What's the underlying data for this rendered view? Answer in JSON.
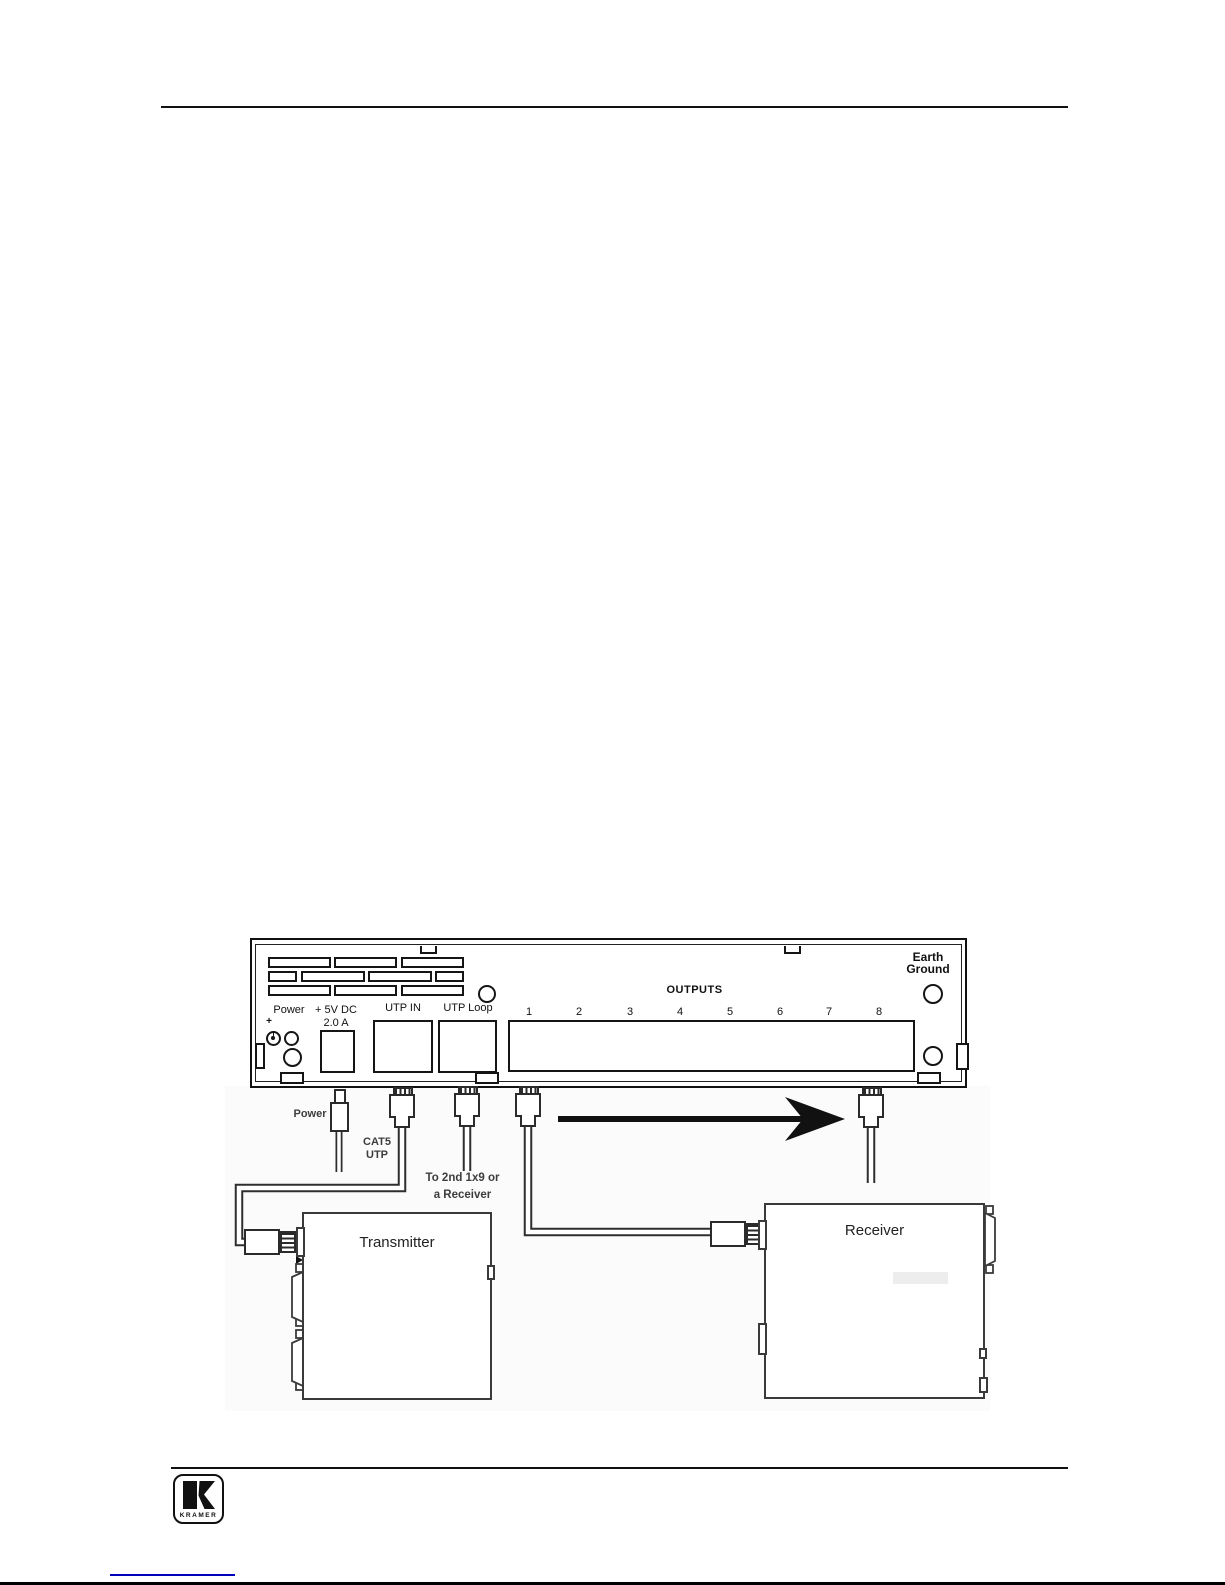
{
  "panel": {
    "earth_label_line1": "Earth",
    "earth_label_line2": "Ground",
    "outputs_label": "OUTPUTS",
    "output_numbers": [
      "1",
      "2",
      "3",
      "4",
      "5",
      "6",
      "7",
      "8"
    ],
    "power_label": "Power",
    "plus_label": "+",
    "dc_label_line1": "+ 5V DC",
    "dc_label_line2": "2.0 A",
    "utp_in_label": "UTP IN",
    "utp_loop_label": "UTP Loop"
  },
  "connections": {
    "power_cable_label": "Power",
    "cat5_label_line1": "CAT5",
    "cat5_label_line2": "UTP",
    "loop_label_line1": "To 2nd 1x9 or",
    "loop_label_line2": "a Receiver",
    "transmitter_label": "Transmitter",
    "receiver_label": "Receiver"
  },
  "footer": {
    "logo_text": "KRAMER"
  },
  "colors": {
    "line": "#111111",
    "link_blue": "#0000bb"
  }
}
